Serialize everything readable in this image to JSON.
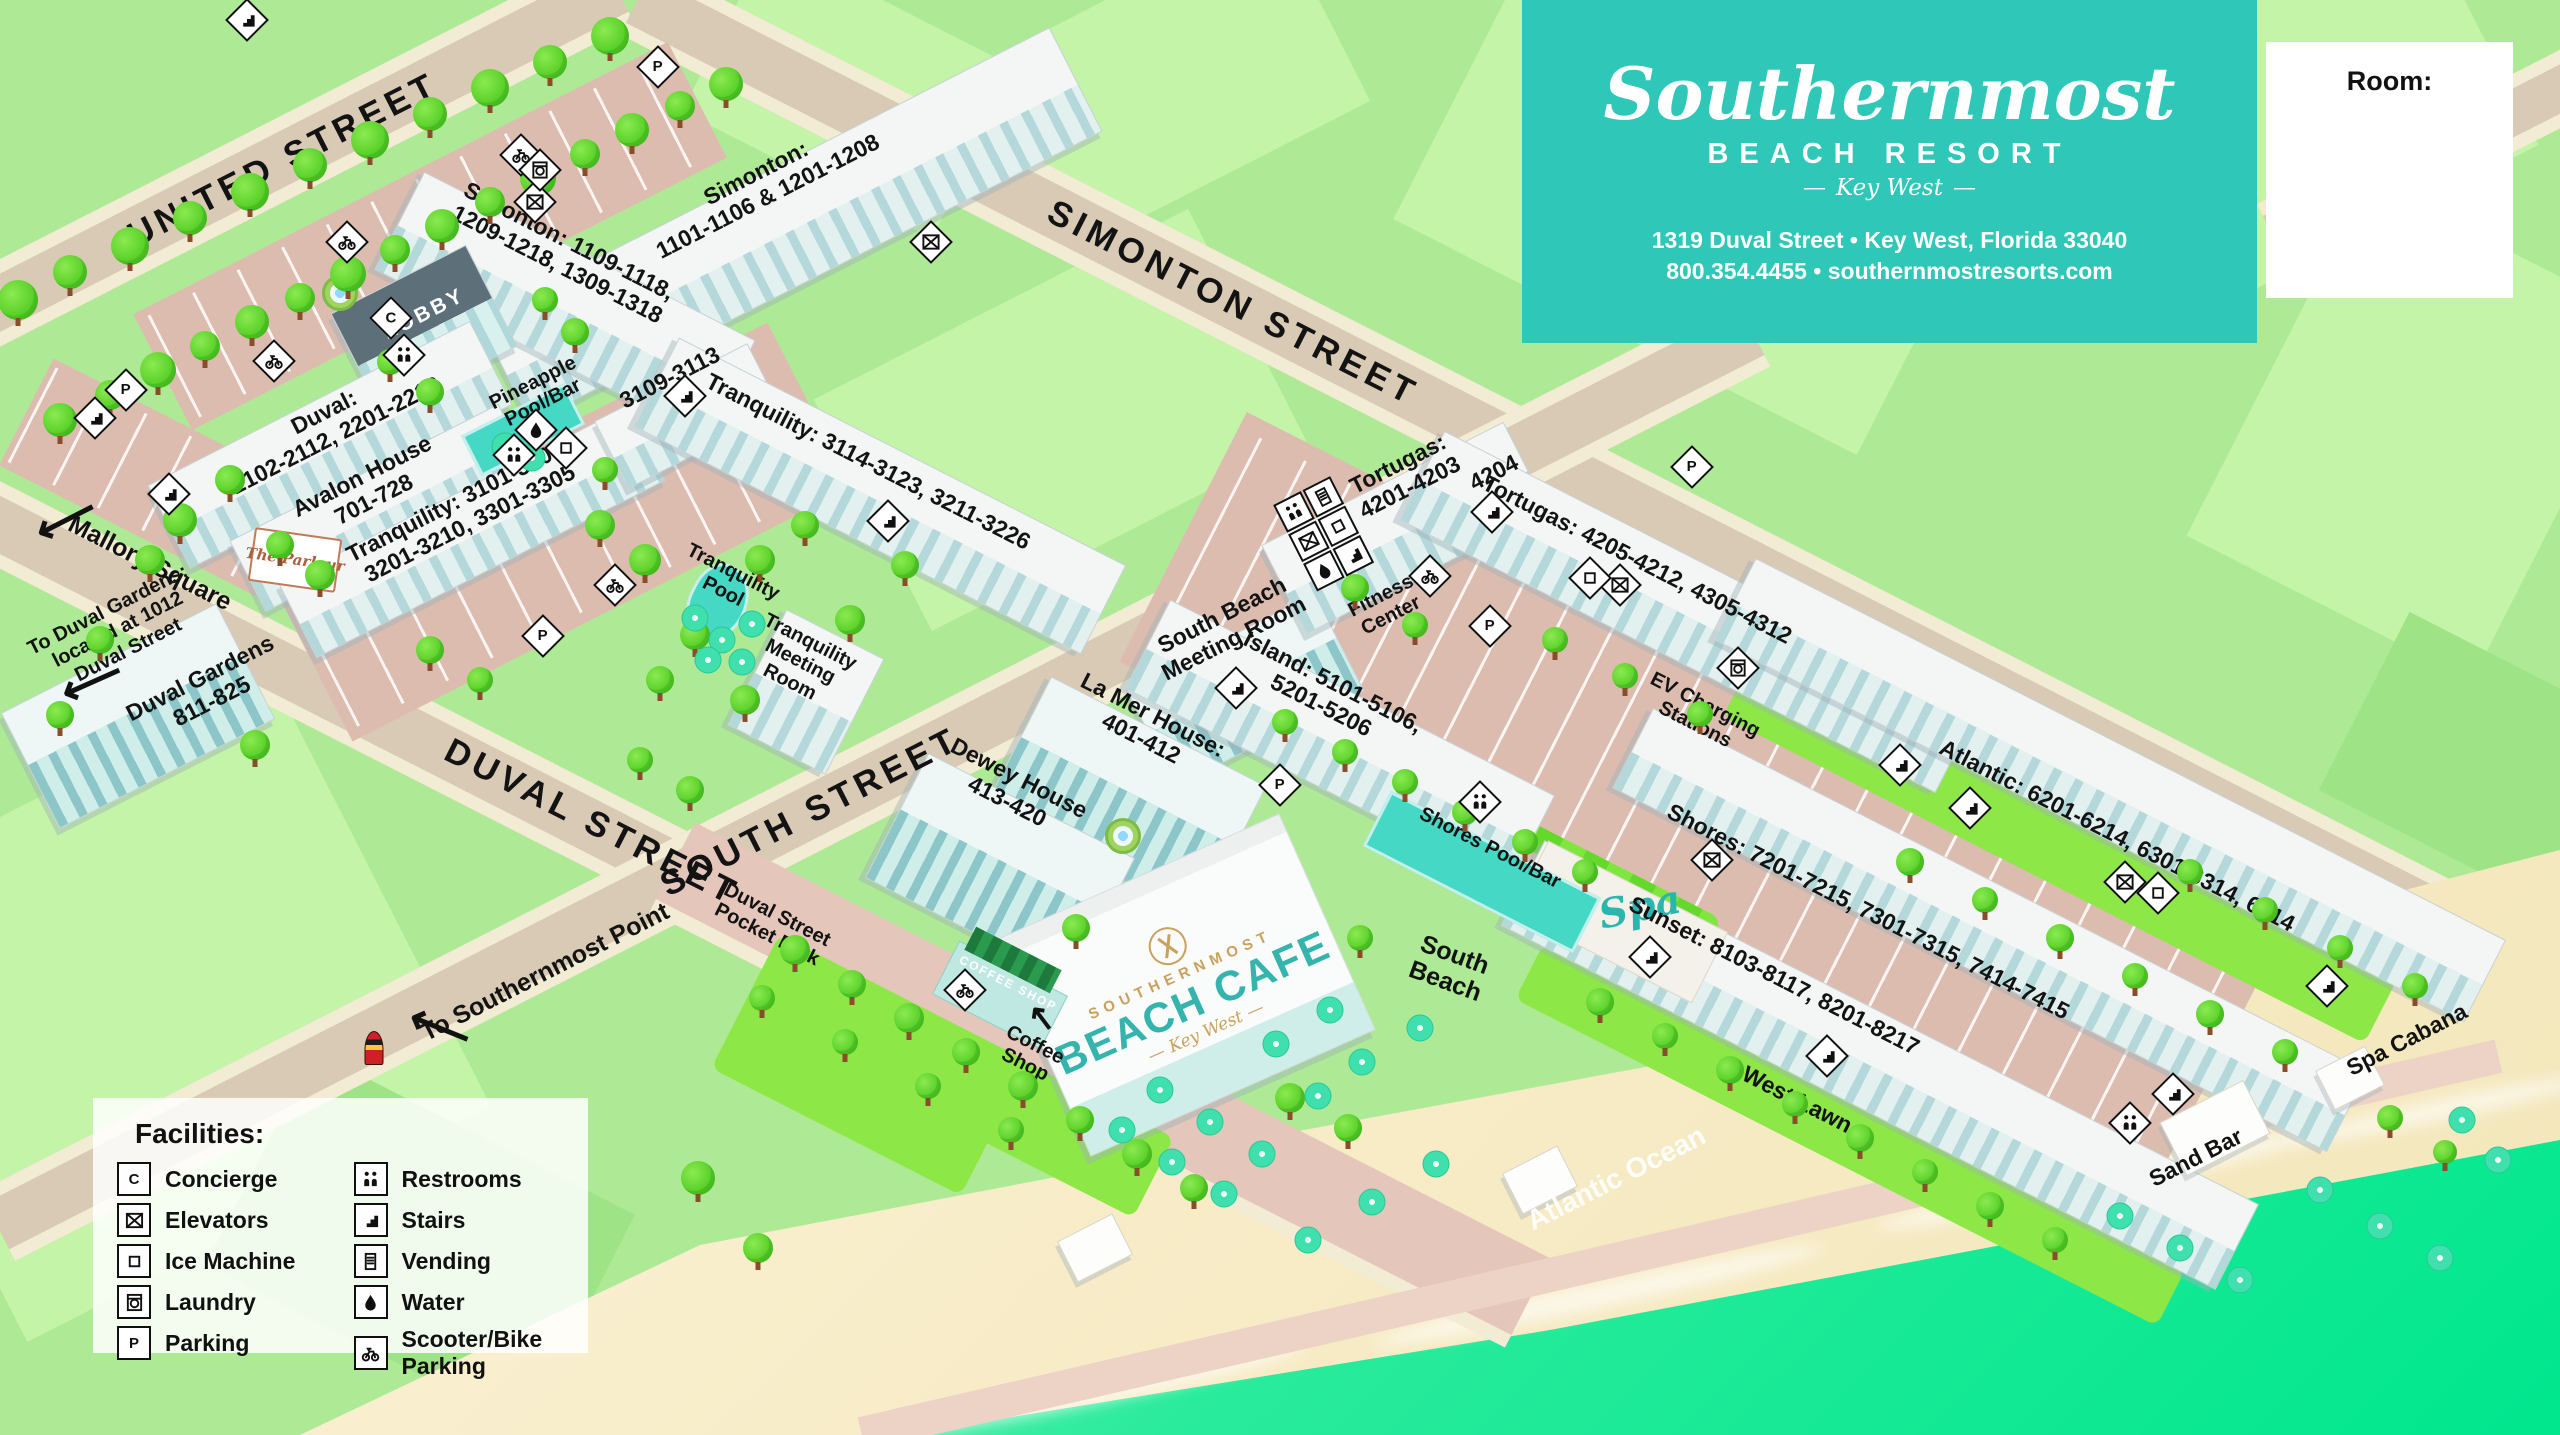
{
  "header": {
    "brand_script": "Southernmost",
    "brand_line2": "BEACH RESORT",
    "brand_line3": "Key West",
    "address": "1319 Duval Street • Key West, Florida 33040",
    "phone_web": "800.354.4455 • southernmostresorts.com"
  },
  "room_box": {
    "label": "Room:"
  },
  "legend": {
    "title": "Facilities:",
    "items": [
      {
        "icon": "concierge",
        "label": "Concierge"
      },
      {
        "icon": "elevators",
        "label": "Elevators"
      },
      {
        "icon": "ice",
        "label": "Ice Machine"
      },
      {
        "icon": "laundry",
        "label": "Laundry"
      },
      {
        "icon": "parking",
        "label": "Parking"
      },
      {
        "icon": "restrooms",
        "label": "Restrooms"
      },
      {
        "icon": "stairs",
        "label": "Stairs"
      },
      {
        "icon": "vending",
        "label": "Vending"
      },
      {
        "icon": "water",
        "label": "Water"
      },
      {
        "icon": "scooter",
        "label": "Scooter/Bike Parking"
      }
    ]
  },
  "streets": {
    "united": "UNITED STREET",
    "simonton": "SIMONTON STREET",
    "duval": "DUVAL STREET",
    "south": "SOUTH STREET"
  },
  "labels": {
    "mallory": "Mallory Square",
    "to_duval_gardens": "To Duval Gardens:\nlocated at 1012\nDuval Street",
    "duval_gardens": "Duval Gardens\n811-825",
    "to_southernmost_point": "To Southernmost Point",
    "pocket_park": "Duval Street\nPocket Park",
    "simonton_1101": "Simonton:\n1101-1106 & 1201-1208",
    "simonton_1109": "Simonton: 1109-1118,\n1209-1218, 1309-1318",
    "rooms_3109": "3109-3113",
    "tranquility_3114": "Tranquility: 3114-3123, 3211-3226",
    "duval_2102": "Duval:\n2102-2112, 2201-2212",
    "avalon": "Avalon House\n701-728",
    "tranquility_3101": "Tranquility: 3101-3108,\n3201-3210, 3301-3305",
    "lobby": "LOBBY",
    "pineapple": "Pineapple\nPool/Bar",
    "parlour": "The Parlour",
    "tranquility_pool": "Tranquility\nPool",
    "tranquility_meeting": "Tranquility\nMeeting\nRoom",
    "south_beach_meeting": "South Beach\nMeeting Room",
    "island": "Island: 5101-5106,\n5201-5206",
    "la_mer": "La Mer House:\n401-412",
    "dewey": "Dewey House\n413-420",
    "fitness": "Fitness\nCenter",
    "tortugas_4201": "Tortugas:\n4201-4203",
    "rooms_4204": "4204",
    "tortugas_4205": "Tortugas: 4205-4212, 4305-4312",
    "ev_charging": "EV Charging\nStations",
    "shores_pool": "Shores Pool/Bar",
    "spa": "Spa",
    "atlantic_rooms": "Atlantic: 6201-6214, 6301-6314, 6414",
    "shores_rooms": "Shores: 7201-7215, 7301-7315, 7414-7415",
    "sunset_rooms": "Sunset: 8103-8117, 8201-8217",
    "west_lawn": "West Lawn",
    "south_beach": "South\nBeach",
    "atlantic_ocean": "Atlantic Ocean",
    "sand_bar": "Sand Bar",
    "spa_cabana": "Spa Cabana",
    "coffee_shop": "Coffee\nShop",
    "coffee_sign": "COFFEE SHOP"
  },
  "cafe": {
    "brand_top": "SOUTHERNMOST",
    "brand_main": "BEACH CAFE",
    "brand_sub": "Key West"
  },
  "arrows": {
    "left": "⟵",
    "up_left": "↖"
  }
}
